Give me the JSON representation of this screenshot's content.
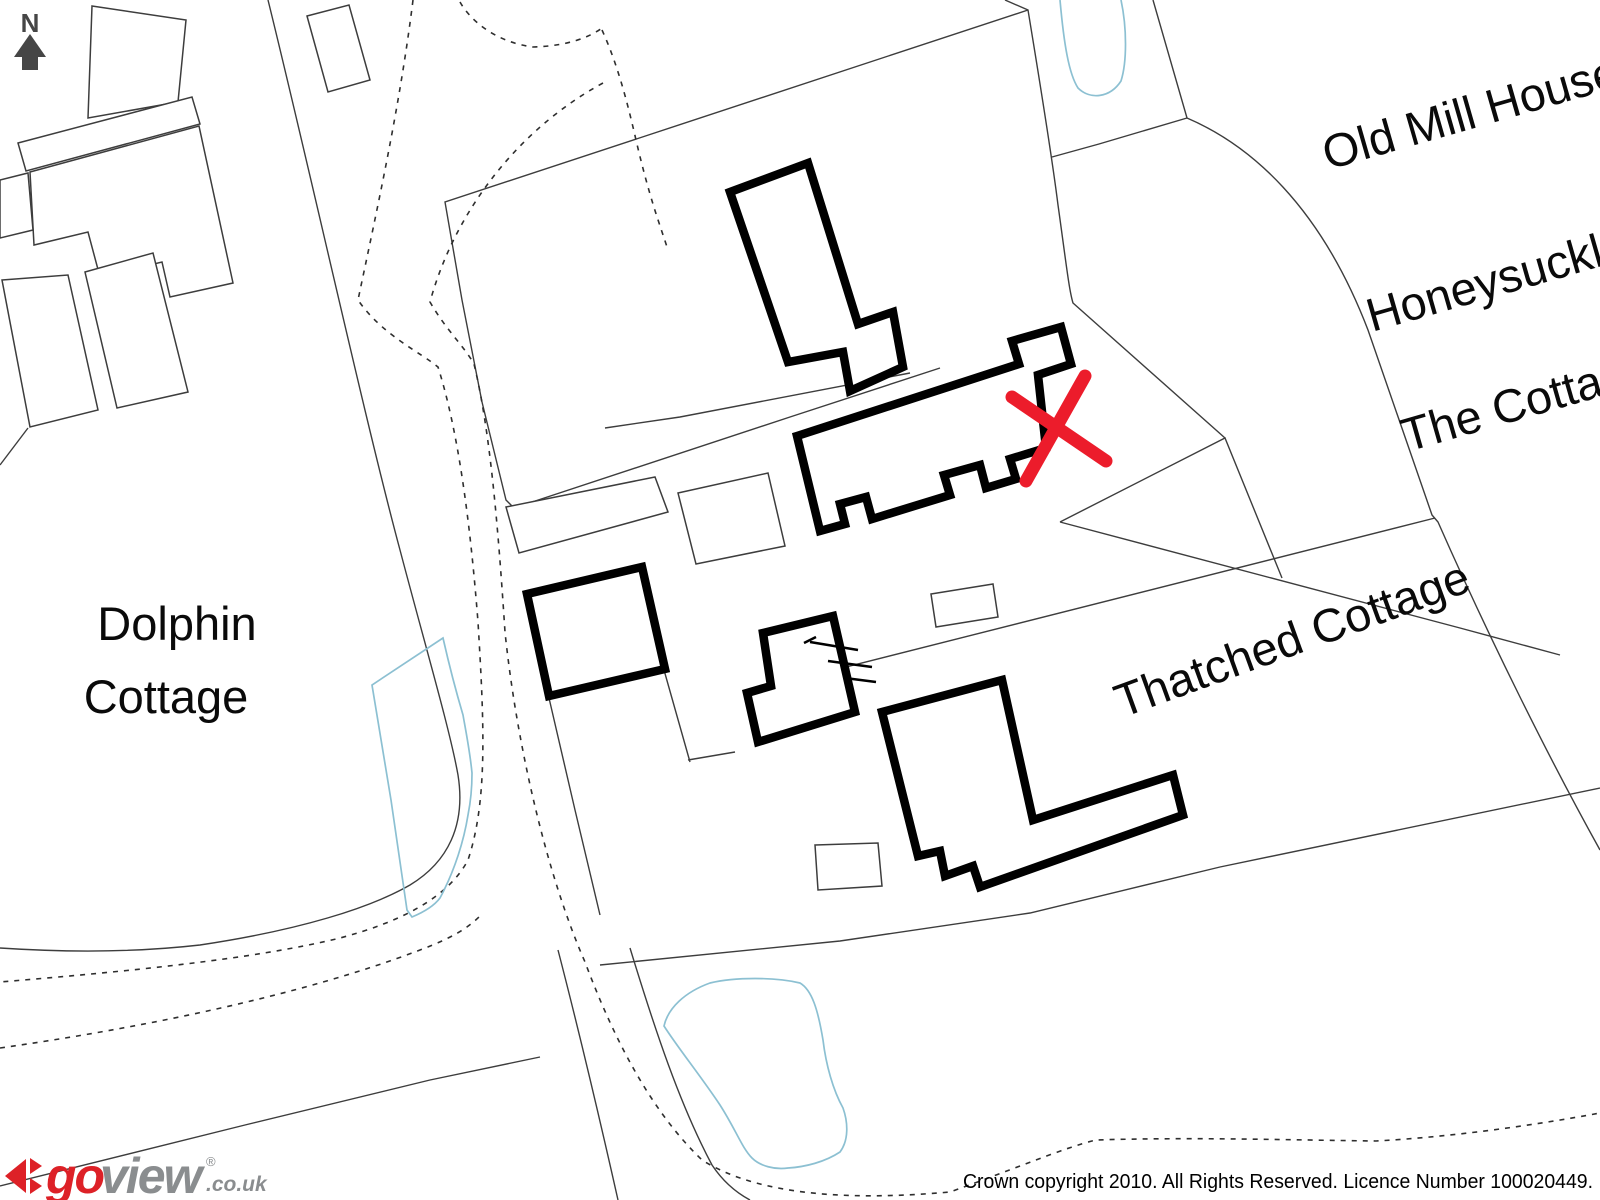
{
  "map": {
    "north_label": "N",
    "labels": {
      "dolphin_line1": "Dolphin",
      "dolphin_line2": "Cottage",
      "old_mill_house": "Old Mill House",
      "honeysuckle": "Honeysuckle",
      "the_cottage": "The Cottage",
      "thatched_cottage": "Thatched Cottage"
    },
    "colors": {
      "building_outline": "#000000",
      "parcel_line": "#3d3d3d",
      "dashed_line": "#2e2e2e",
      "water_line": "#8cc0d2",
      "marker_red": "#ec1c2b",
      "north_arrow": "#464646"
    }
  },
  "footer": {
    "logo": {
      "go": "go",
      "view": "view",
      "registered": "®",
      "domain": ".co.uk",
      "accent_color": "#dd2127",
      "gray_color": "#8a8d8f"
    },
    "copyright": "Crown copyright 2010. All Rights Reserved. Licence Number 100020449."
  }
}
